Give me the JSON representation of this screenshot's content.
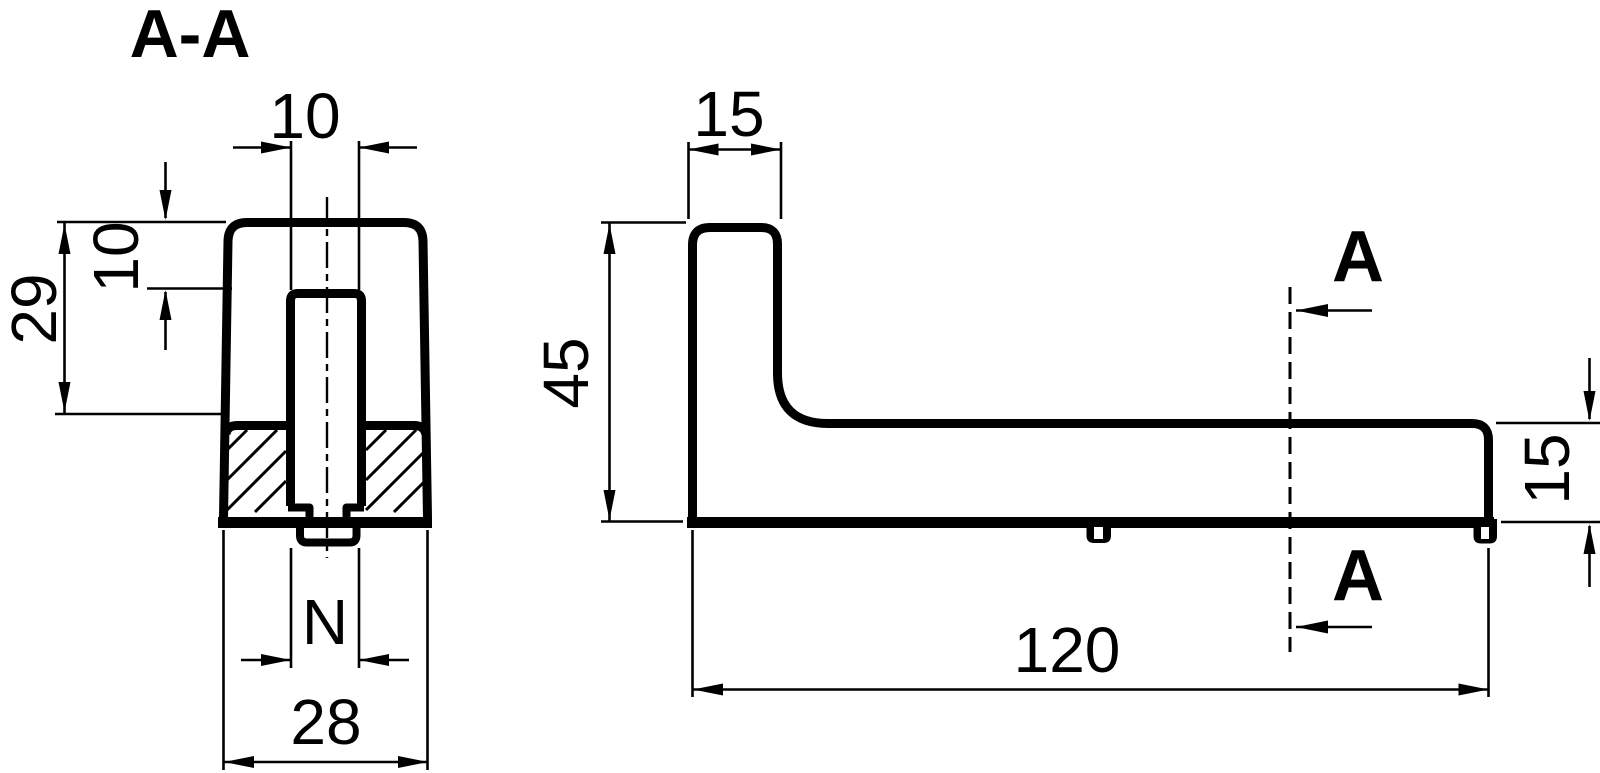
{
  "drawing": {
    "background": "#ffffff",
    "line_color": "#000000",
    "section_view": {
      "label": "A-A",
      "dim_slot_width": "10",
      "dim_slot_depth": "10",
      "dim_height_to_base": "29",
      "dim_thread": "N",
      "dim_overall_width": "28"
    },
    "side_view": {
      "dim_upright_width": "15",
      "dim_overall_height": "45",
      "dim_base_thickness": "15",
      "dim_overall_length": "120",
      "section_arrow_top": "A",
      "section_arrow_bottom": "A"
    }
  }
}
